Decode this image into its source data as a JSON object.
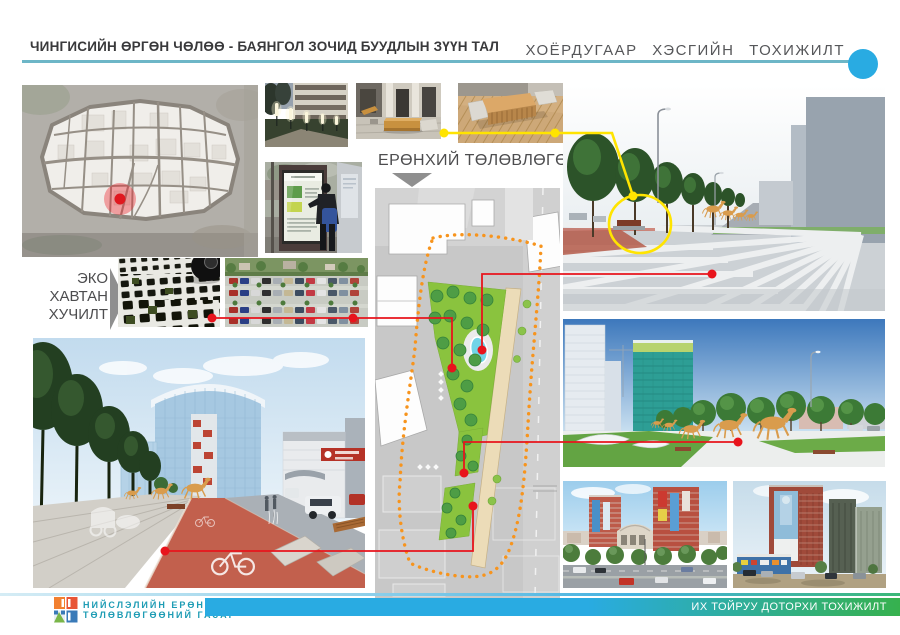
{
  "page": {
    "width_px": 900,
    "height_px": 635,
    "background": "#ffffff"
  },
  "header": {
    "title": "ЧИНГИСИЙН ӨРГӨН ЧӨЛӨӨ - БАЯНГОЛ ЗОЧИД БУУДЛЫН ЗҮҮН ТАЛ",
    "section_title": "ХОЁРДУГААР  ХЭСГИЙН  ТОХИЖИЛТ",
    "rule_color": "#6db6c7",
    "bullet_color": "#29abe2"
  },
  "labels": {
    "master_plan": "ЕРӨНХИЙ ТӨЛӨВЛӨГӨӨ",
    "eco_paving": [
      "ЭКО",
      "ХАВТАН",
      "ХУЧИЛТ"
    ]
  },
  "connectors": {
    "red": "#e8141c",
    "yellow": "#ffe400",
    "plan_boundary_orange": "#f7941d",
    "map_marker_red": "#ed1c24",
    "park_green": "#8ac33e"
  },
  "footer": {
    "org_line1": "НИЙСЛЭЛИЙН ЕРӨНХИЙ",
    "org_line2": "ТӨЛӨВЛӨГӨӨНИЙ ГАЗАР",
    "org_color": "#1d9cb4",
    "banner_text": "ИХ ТОЙРУУ ДОТОРХИ ТОХИЖИЛТ",
    "banner_gradient_start": "#29abe2",
    "banner_gradient_end": "#36b14e"
  },
  "images": {
    "city_map": "City map with red location marker",
    "street_lights_photo": "Street lighting reference photo at dusk",
    "courtyard_bench_photo": "Courtyard wooden bench reference photo",
    "deck_bench_photo": "Wooden deck bench reference photo",
    "info_kiosk_photo": "Interactive information kiosk photo",
    "eco_paving_photo": "Eco grass paver close-up with tire",
    "parking_photo": "Aerial parking lot photo",
    "master_plan_drawing": "Landscape master plan with park, pond and dotted boundary",
    "promenade_render": "Promenade 3D render with tree row and horse sculptures",
    "plaza_render": "Plaza 3D render with galloping horse sculptures",
    "existing_site_photo_1": "Existing site photo - hotel buildings and road",
    "existing_site_photo_2": "Existing site photo - residential towers",
    "boulevard_render": "Boulevard 3D render with red bike lane"
  }
}
